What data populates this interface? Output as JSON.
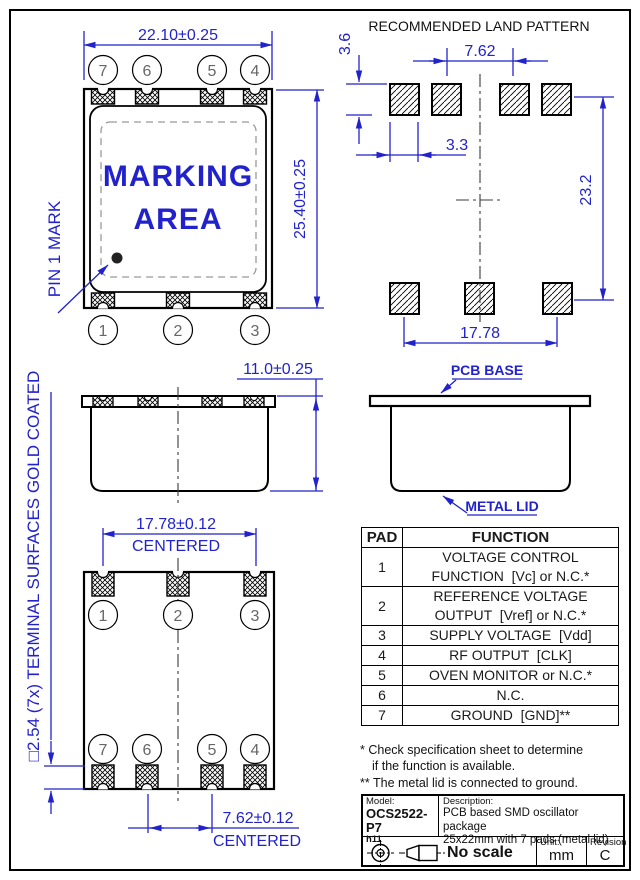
{
  "colors": {
    "dimension_blue": "#2222cc",
    "line_black": "#000000",
    "pin_number_gray": "#666666"
  },
  "top_view": {
    "dim_width": "22.10±0.25",
    "dim_height": "25.40±0.25",
    "marking_line1": "MARKING",
    "marking_line2": "AREA",
    "pin1_label": "PIN 1 MARK",
    "pins_top": [
      "7",
      "6",
      "5",
      "4"
    ],
    "pins_bottom": [
      "1",
      "2",
      "3"
    ]
  },
  "land_pattern": {
    "title": "RECOMMENDED LAND PATTERN",
    "dim_pad_height": "3.6",
    "dim_inner_pitch": "7.62",
    "dim_pad_width": "3.3",
    "dim_row_pitch": "23.2",
    "dim_outer_pitch": "17.78"
  },
  "side_view_left": {
    "dim_height": "11.0±0.25"
  },
  "side_view_right": {
    "pcb_base_label": "PCB BASE",
    "metal_lid_label": "METAL LID"
  },
  "bottom_view": {
    "dim_top": "17.78±0.12",
    "dim_top_note": "CENTERED",
    "dim_bottom": "7.62±0.12",
    "dim_bottom_note": "CENTERED",
    "terminal_note": "□2.54 (7x) TERMINAL SURFACES GOLD COATED",
    "pins_top": [
      "1",
      "2",
      "3"
    ],
    "pins_bottom": [
      "7",
      "6",
      "5",
      "4"
    ]
  },
  "pad_table": {
    "headers": [
      "PAD",
      "FUNCTION"
    ],
    "rows": [
      {
        "pad": "1",
        "line1": "VOLTAGE CONTROL",
        "line2": "FUNCTION  [Vc] or N.C.*"
      },
      {
        "pad": "2",
        "line1": "REFERENCE VOLTAGE",
        "line2": "OUTPUT  [Vref] or N.C.*"
      },
      {
        "pad": "3",
        "line1": "SUPPLY VOLTAGE  [Vdd]"
      },
      {
        "pad": "4",
        "line1": "RF OUTPUT  [CLK]"
      },
      {
        "pad": "5",
        "line1": "OVEN MONITOR or N.C.*"
      },
      {
        "pad": "6",
        "line1": "N.C."
      },
      {
        "pad": "7",
        "line1": "GROUND  [GND]**"
      }
    ],
    "footnotes": [
      "* Check specification sheet to determine",
      "if the function is available.",
      "** The metal lid is connected to ground."
    ]
  },
  "title_block": {
    "model_label": "Model:",
    "model": "OCS2522-P7",
    "model_sub": "h11",
    "description_label": "Description:",
    "description_line1": "PCB based SMD oscillator package",
    "description_line2": "25x22mm with 7 pads (metal lid)",
    "scale": "No scale",
    "unit_label": "Unit:",
    "unit": "mm",
    "revision_label": "Revision",
    "revision": "C"
  }
}
